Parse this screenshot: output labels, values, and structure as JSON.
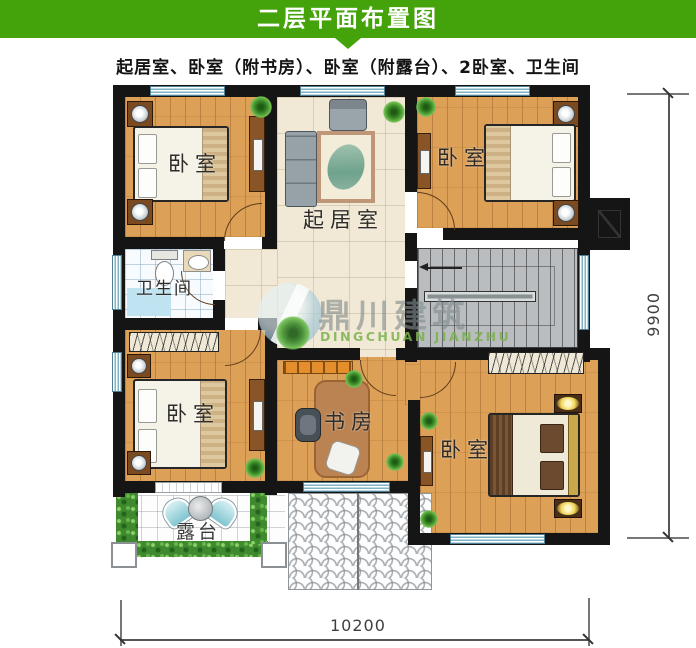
{
  "header": {
    "title": "二层平面布置图"
  },
  "subtitle": "起居室、卧室（附书房）、卧室（附露台）、2卧室、卫生间",
  "rooms": {
    "bedroom_top_left": {
      "label": "卧室"
    },
    "bedroom_top_right": {
      "label": "卧室"
    },
    "living_room": {
      "label": "起居室"
    },
    "bathroom": {
      "label": "卫生间"
    },
    "bedroom_bottom_left": {
      "label": "卧室"
    },
    "study": {
      "label": "书房"
    },
    "bedroom_bottom_right": {
      "label": "卧室"
    },
    "terrace": {
      "label": "露台"
    }
  },
  "dimensions": {
    "width_mm": "10200",
    "height_mm": "9900"
  },
  "watermark": {
    "name": "鼎川建筑",
    "romanized": "DINGCHUAN JIANZHU"
  },
  "icons": {
    "logo": "circle-swoosh-logo",
    "stairs_arrow": "left-arrow",
    "flue": "chimney-flue-symbol"
  },
  "colors": {
    "header_green": "#44a30a",
    "wall_black": "#151515",
    "wood_floor": "#dda057",
    "tile_cream": "#f1e9d5",
    "bath_blue": "#bfe3f1",
    "stairs_gray": "#b9bdbf",
    "hedge_green": "#3f8a2e",
    "window_teal": "#7fb3c6",
    "watermark_green": "#7ab24c"
  }
}
